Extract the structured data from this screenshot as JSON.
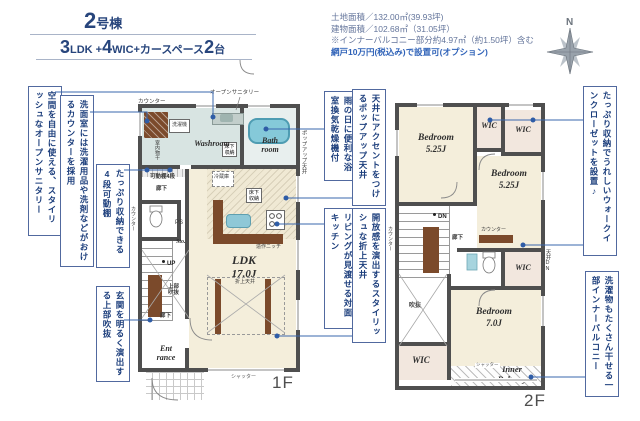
{
  "header": {
    "unit_num": "2",
    "unit_suffix": "号棟",
    "spec_n1": "3",
    "spec_u1": "LDK +",
    "spec_n2": "4",
    "spec_u2": "WIC+カースペース",
    "spec_n3": "2",
    "spec_u3": "台"
  },
  "site_info": {
    "line1": "土地面積／132.00㎡(39.93坪)",
    "line2": "建物面積／102.68㎡（31.05坪）",
    "line3": "※インナーバルコニー部分約4.97㎡（約1.50坪）含む",
    "line4": "網戸10万円(税込み)で設置可(オプション)"
  },
  "compass": {
    "north": "N"
  },
  "callouts": {
    "open_sanitary": "空間を自由に使える、スタイリッシュなオープンサニタリー",
    "laundry_counter": "洗面室には洗濯用品や洗剤などがおけるカウンターを採用",
    "movable_shelf": "たっぷり収納できる4段可動棚",
    "entrance_void": "玄関を明るく演出する上部吹抜",
    "popup_ceiling": "天井にアクセントをつけるポップアップ天井",
    "bath_dryer": "雨の日に便利な浴室換気乾燥機付",
    "coffered_ceiling": "開放感を演出するスタイリッシュな折上天井",
    "open_kitchen": "リビングが見渡せる対面キッチン",
    "wic": "たっぷり収納でうれしいウォークインクローゼットを設置♪",
    "inner_balcony": "洗濯物もたくさん干せる一部インナーバルコニー"
  },
  "floor1": {
    "label": "1F",
    "rooms": {
      "washroom": "Washroom",
      "bath_1": "Bath",
      "bath_2": "room",
      "ldk": "LDK",
      "ldk_size": "17.0J",
      "entrance_1": "Ent",
      "entrance_2": "rance",
      "storage": "Sto."
    },
    "labels": {
      "counter": "カウンター",
      "washer": "洗濯機",
      "indoor_drying": "室内物干",
      "open_sanitary": "オープンサニタリー",
      "underfloor": "床下収納",
      "movable_shelf": "可動棚4段",
      "hall": "廊下",
      "ps": "PS",
      "up": "UP",
      "upper_void_1": "上部",
      "upper_void_2": "吹抜",
      "fridge": "冷蔵庫",
      "niche": "造作ニッチ",
      "coffered": "折上天井",
      "popup": "ポップアップ天井",
      "shutter": "シャッター"
    }
  },
  "floor2": {
    "label": "2F",
    "rooms": {
      "bedroom": "Bedroom",
      "bedroom1_size": "5.25J",
      "bedroom2_size": "5.25J",
      "bedroom3_size": "7.0J",
      "wic": "WIC",
      "balcony_1": "Inner",
      "balcony_2": "Balcony"
    },
    "labels": {
      "dn": "DN",
      "hall": "廊下",
      "void": "吹抜",
      "counter": "カウンター",
      "ceiling_dn": "天井DN",
      "shutter": "シャッター"
    }
  },
  "colors": {
    "callout_blue": "#1c3e7c",
    "leader_blue": "#3a67ae",
    "wall_gray": "#4f4f4f",
    "floor_cream": "#f4eedb",
    "wash_green": "#d8e4e2",
    "tub_blue": "#85c9d9",
    "wood_brown": "#7b4a2b",
    "wic_pink": "#f2e7de"
  }
}
